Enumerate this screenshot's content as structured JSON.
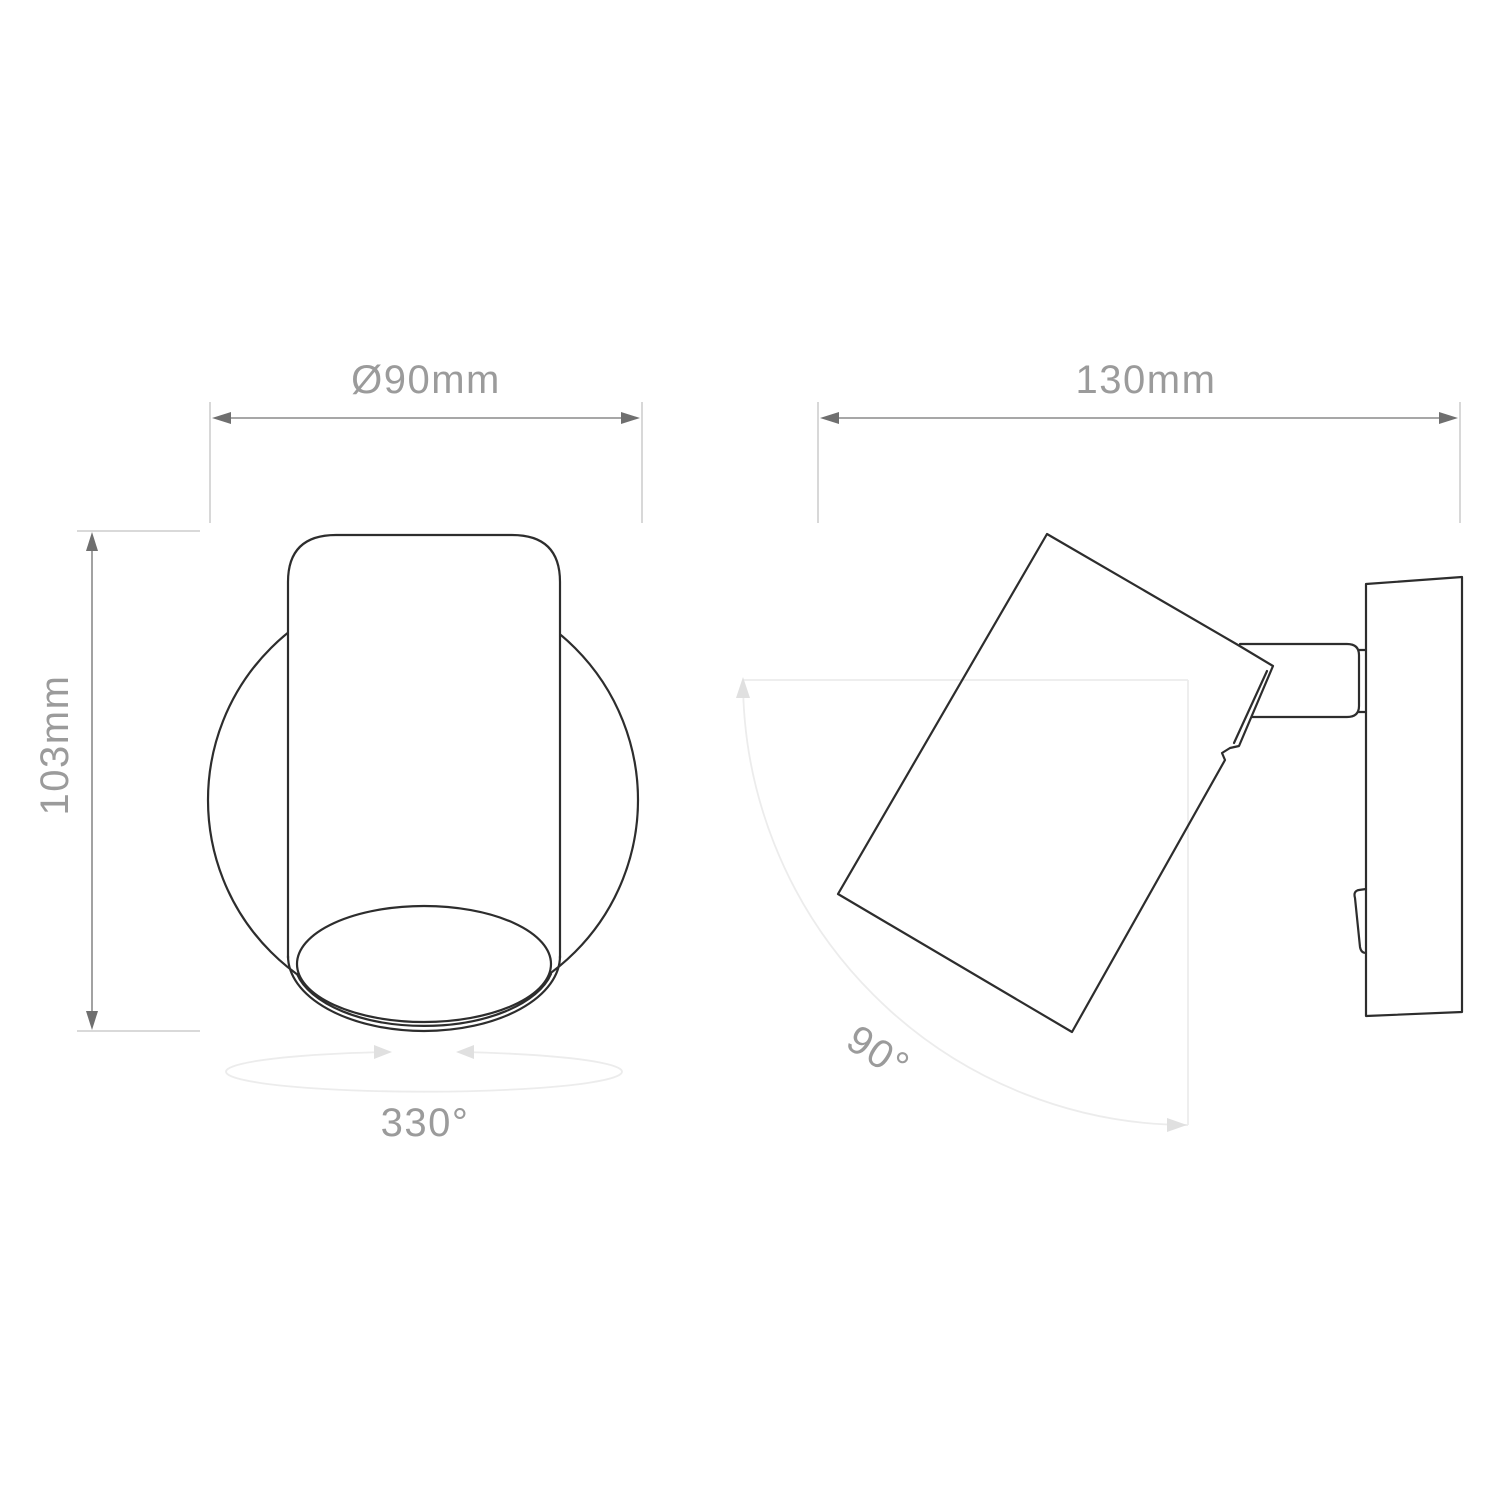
{
  "drawing": {
    "front_view": {
      "diameter_label": "Ø90mm",
      "height_label": "103mm",
      "rotation_label": "330°"
    },
    "side_view": {
      "depth_label": "130mm",
      "tilt_label": "90°"
    }
  },
  "colors": {
    "background": "#ffffff",
    "outline": "#2d2d2d",
    "dimension_line": "#8a8a8a",
    "dimension_arrow": "#6f6f6f",
    "extension_line": "#c2c2c2",
    "dimension_text": "#9b9b9b",
    "faint_guide": "#ececec",
    "faint_arrow": "#e0e0e0"
  }
}
